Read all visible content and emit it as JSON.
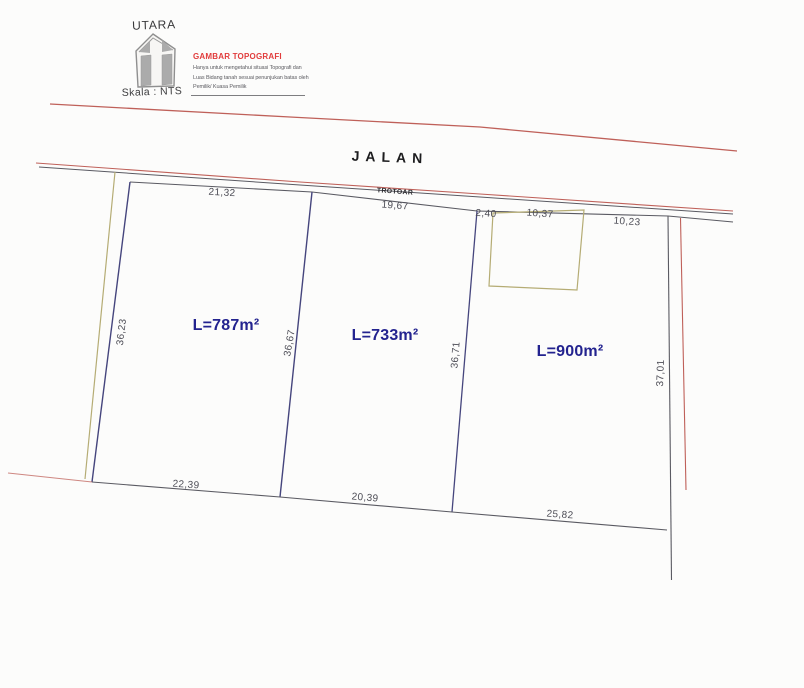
{
  "header": {
    "north_label": "UTARA",
    "scale_label": "Skala : NTS",
    "title": "GAMBAR TOPOGRAFI",
    "note_line1": "Hanya untuk mengetahui situasi Topografi dan",
    "note_line2": "Luas Bidang tanah sesuai penunjukan batas oleh",
    "note_line3": "Pemilik/ Kuasa Pemilik"
  },
  "road": {
    "name": "JALAN",
    "sidewalk": "TROTOAR"
  },
  "parcels": [
    {
      "area_label": "L=787m²",
      "front": "21,32",
      "back": "22,39",
      "left": "36,23",
      "right": "36,67"
    },
    {
      "area_label": "L=733m²",
      "front": "19,67",
      "back": "20,39",
      "right": "36,71"
    },
    {
      "area_label": "L=900m²",
      "front_segments": [
        "2,40",
        "10,37",
        "10,23"
      ],
      "back": "25,82",
      "right": "37,01"
    }
  ],
  "colors": {
    "title_red": "#e13c3c",
    "area_blue": "#23238f",
    "boundary_blue": "#45457d",
    "road_red": "#bf6059",
    "line_gray": "#5a5a62",
    "survey_olive": "#b5ac74",
    "north_symbol_gray": "#8f8f8f"
  }
}
